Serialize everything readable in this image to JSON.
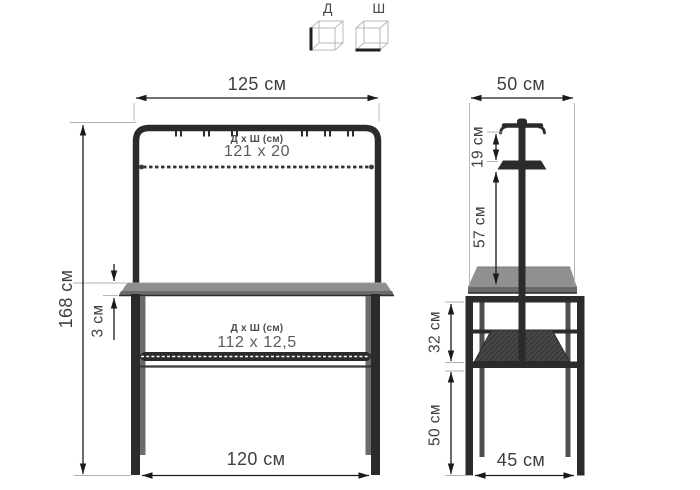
{
  "legend": {
    "length_icon_label": "Д",
    "width_icon_label": "Ш"
  },
  "front_view": {
    "top_width_label": "125 см",
    "upper_shelf_title": "Д x Ш (см)",
    "upper_shelf_size": "121 x 20",
    "overall_height_label": "168 см",
    "tabletop_thickness_label": "3 см",
    "lower_shelf_title": "Д x Ш (см)",
    "lower_shelf_size": "112 x 12,5",
    "bottom_width_label": "120 см"
  },
  "side_view": {
    "top_depth_label": "50 см",
    "hooks_to_shelf_label": "19 см",
    "shelf_to_tabletop_label": "57 см",
    "tabletop_to_lower_shelf_label": "32 см",
    "lower_height_label": "50 см",
    "bottom_depth_label": "45 см"
  },
  "colors": {
    "frame": "#2b2b2b",
    "tabletop": "#909090",
    "dimension_lines": "#1a1a1a",
    "text": "#3f3f3f",
    "background": "#ffffff"
  }
}
